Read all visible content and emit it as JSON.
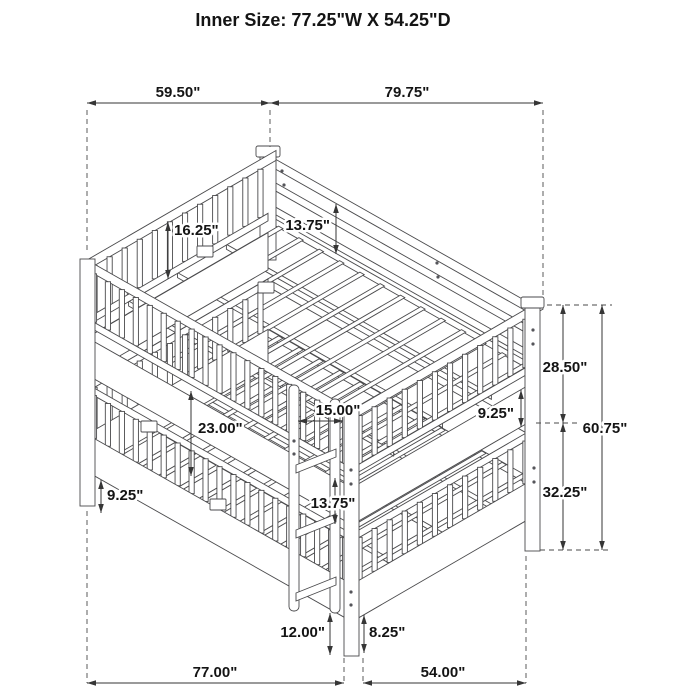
{
  "title": "Inner Size: 77.25\"W X 54.25\"D",
  "labels": {
    "top_width": "59.50\"",
    "top_length": "79.75\"",
    "headboard_rail_to_slats": "16.25\"",
    "upper_guard_height": "13.75\"",
    "upper_section_height": "28.50\"",
    "upper_side_rail": "9.25\"",
    "overall_height": "60.75\"",
    "lower_section_height": "32.25\"",
    "bunk_clearance": "23.00\"",
    "ladder_to_post": "15.00\"",
    "lower_guard_height": "13.75\"",
    "lower_side_rail": "9.25\"",
    "ladder_floor_height": "12.00\"",
    "underbed_clearance": "8.25\"",
    "bed_length": "77.00\"",
    "bed_width": "54.00\""
  }
}
